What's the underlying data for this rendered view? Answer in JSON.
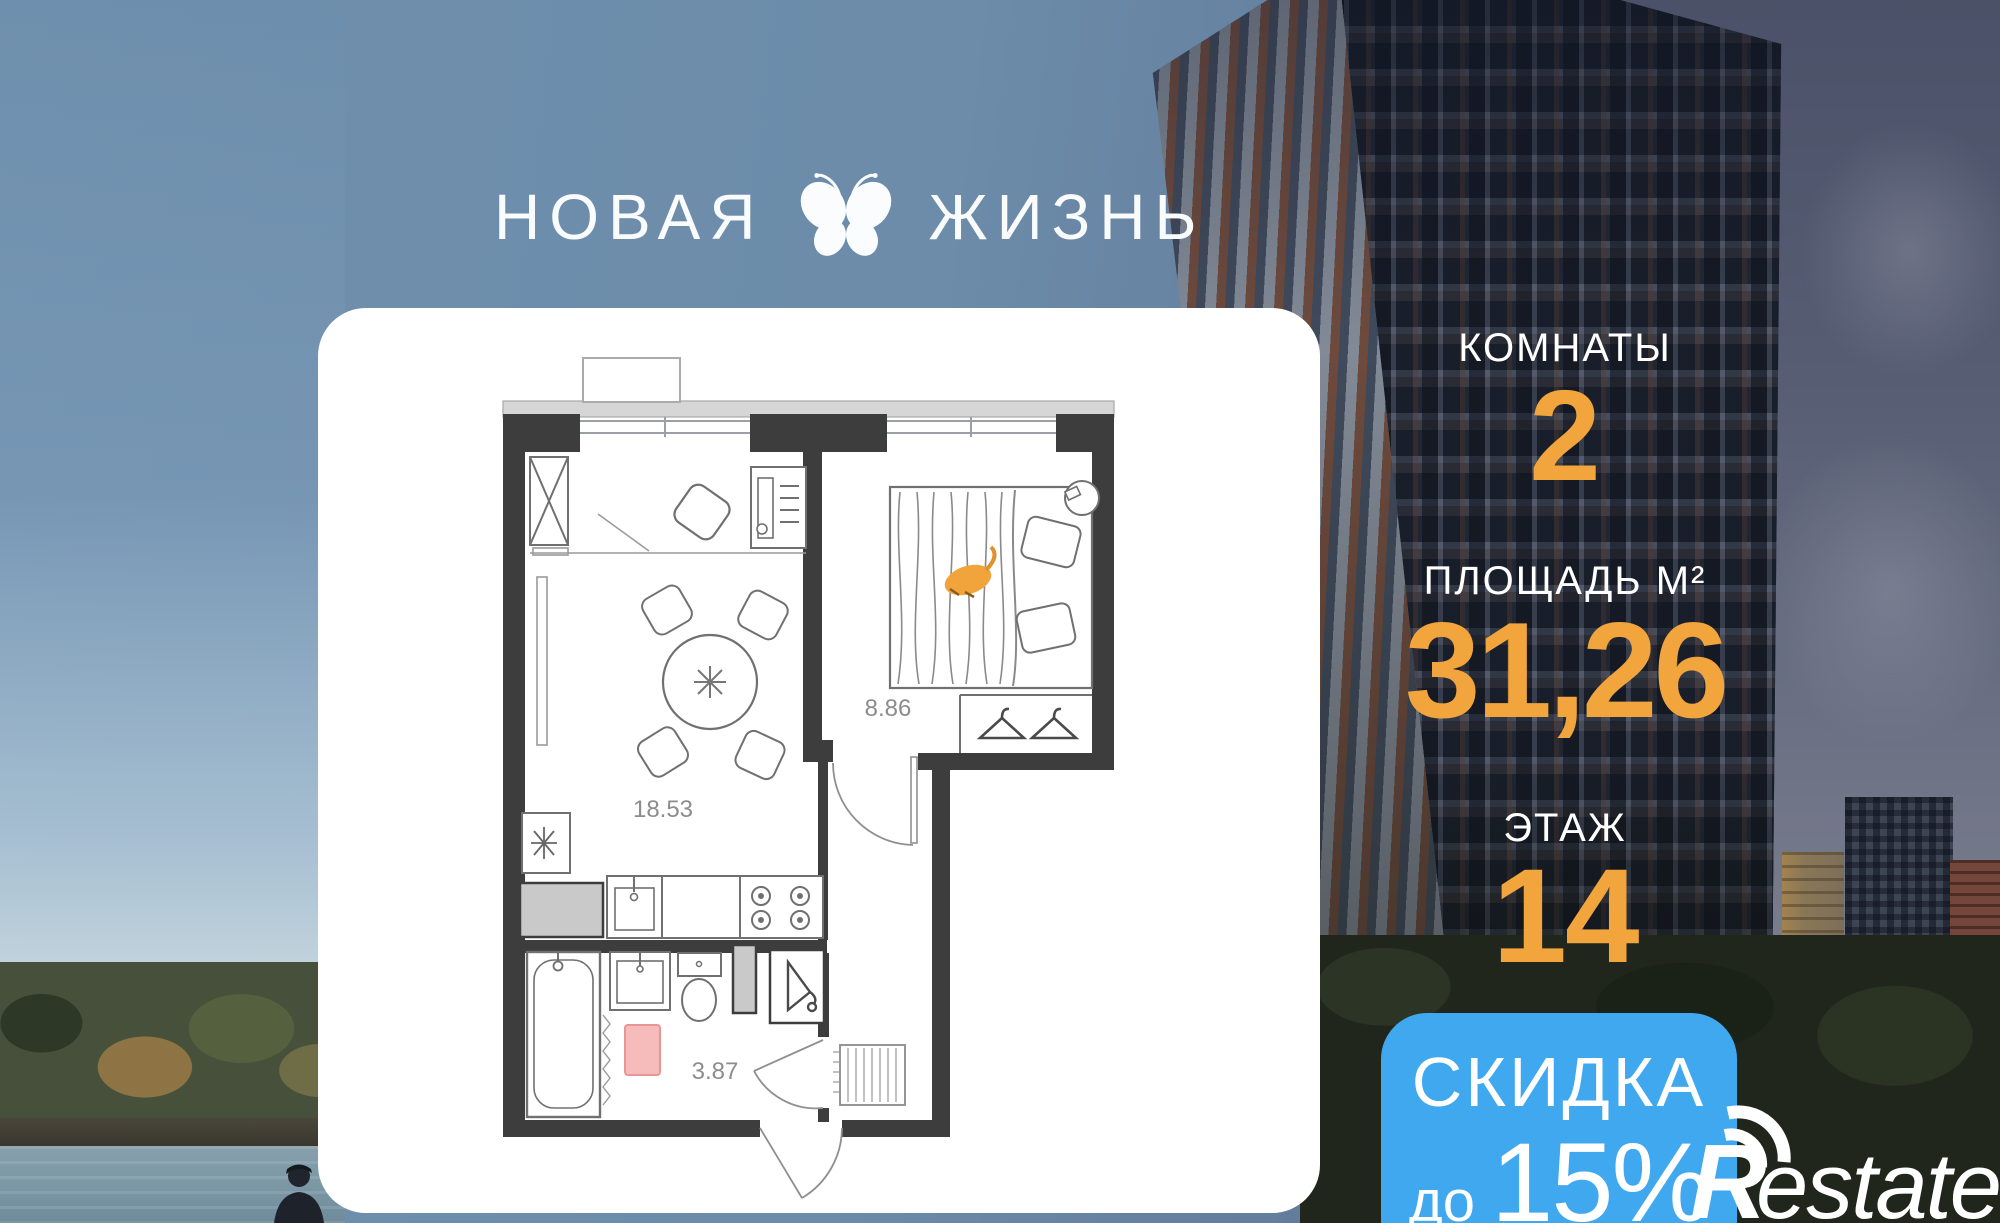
{
  "logo": {
    "word_left": "НОВАЯ",
    "word_right": "ЖИЗНЬ"
  },
  "stats": {
    "rooms": {
      "label": "КОМНАТЫ",
      "value": "2"
    },
    "area": {
      "label": "ПЛОЩАДЬ М²",
      "value": "31,26"
    },
    "floor": {
      "label": "ЭТАЖ",
      "value": "14"
    }
  },
  "discount": {
    "title": "СКИДКА",
    "prefix": "до",
    "value": "15%"
  },
  "watermark": {
    "brand_initial": "R",
    "brand_rest": "estate"
  },
  "floorplan": {
    "rooms": [
      {
        "name": "living-kitchen",
        "area_label": "18.53"
      },
      {
        "name": "bedroom",
        "area_label": "8.86"
      },
      {
        "name": "bathroom",
        "area_label": "3.87"
      }
    ]
  },
  "colors": {
    "accent_orange": "#F2A53C",
    "discount_blue": "#40A8EE",
    "wall_dark": "#3D3D3D",
    "rug_pink": "#F6BCBC"
  }
}
